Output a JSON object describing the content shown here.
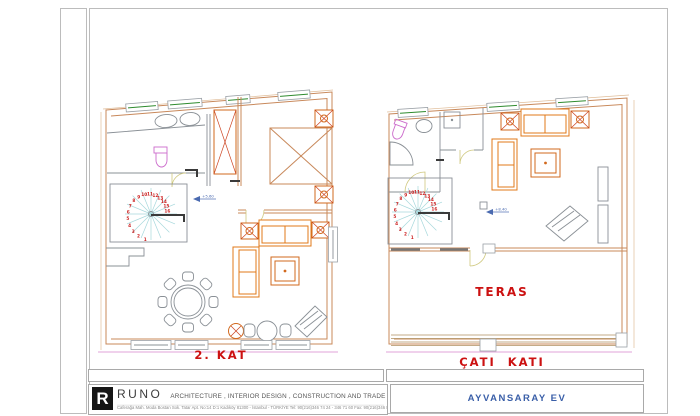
{
  "plans": {
    "left": {
      "label": "2. KAT",
      "level_mark": "+5.60",
      "stair_numbers": [
        "1",
        "2",
        "3",
        "4",
        "5",
        "6",
        "7",
        "8",
        "9",
        "10",
        "11",
        "12",
        "13",
        "14",
        "15",
        "16"
      ]
    },
    "right": {
      "label": "ÇATI KATI",
      "area_label": "TERAS",
      "level_mark": "+8.40",
      "stair_numbers": [
        "1",
        "2",
        "3",
        "4",
        "5",
        "6",
        "7",
        "8",
        "9",
        "10",
        "11",
        "12",
        "13",
        "14",
        "15",
        "16"
      ]
    }
  },
  "title_block": {
    "company_initial": "R",
    "company_name": "RUNO",
    "company_tagline": "ARCHITECTURE , INTERIOR DESIGN , CONSTRUCTION AND TRADE LTD.",
    "company_address": "Caferağa Mah. Moda Bostan Sok. Tatar Apt. No:14 D:1 Kadıköy 81300 - İstanbul - TÜRKİYE   Tel: 90(216)346 74 24 - 346 71 60  Fax: 90(216)346 85 46",
    "project_name": "AYVANSARAY EV"
  },
  "colors": {
    "label_red": "#cc1111",
    "project_blue": "#3a5fa8",
    "wall_orange": "#c8885a",
    "furniture_orange": "#e07818",
    "stair_tread_cyan": "#a6d8dc",
    "fixture_magenta": "#cc6ccc",
    "window_green": "#2e8b2e",
    "level_blue": "#4a6ab0"
  }
}
